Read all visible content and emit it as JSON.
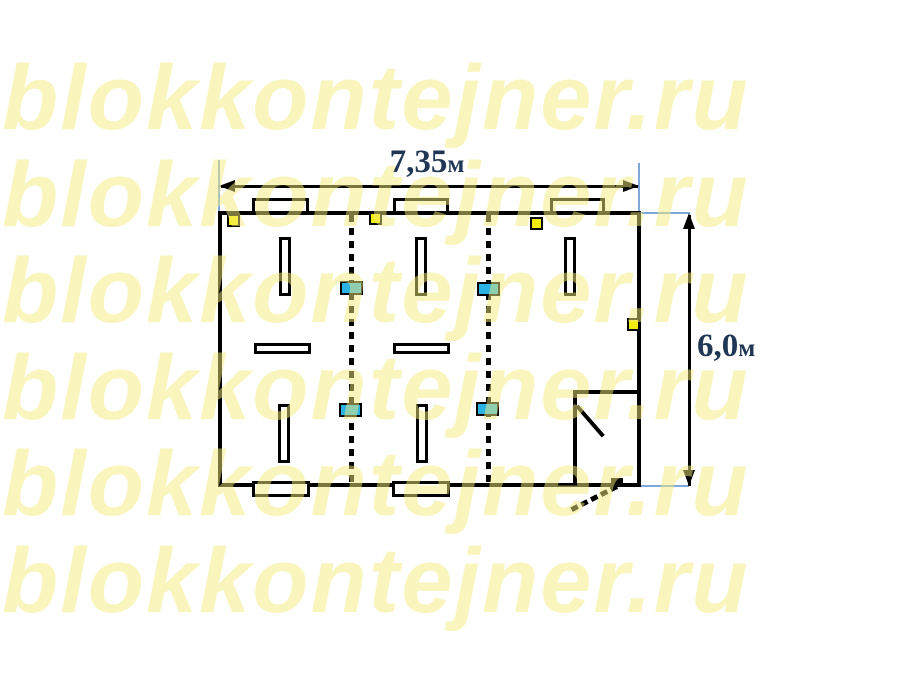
{
  "watermark": {
    "text": "blokkontejner.ru",
    "rows": 6,
    "color": "rgba(244,235,124,0.5)"
  },
  "dimensions": {
    "width": {
      "value": "7,35",
      "unit": "м"
    },
    "height": {
      "value": "6,0",
      "unit": "м"
    },
    "text_color": "#1F3655",
    "extension_line_color": "#7FA8DA"
  },
  "plan": {
    "colors": {
      "wall": "#000000",
      "fill": "#FFFFFF",
      "switch": "#F0EC0E",
      "socket": "#29B2E3"
    },
    "joints": [
      {
        "x": 349
      },
      {
        "x": 486
      }
    ],
    "windows_top": [
      {
        "x": 252,
        "w": 57
      },
      {
        "x": 393,
        "w": 56
      },
      {
        "x": 550,
        "w": 55
      }
    ],
    "windows_bottom": [
      {
        "x": 252,
        "w": 58
      },
      {
        "x": 392,
        "w": 58
      }
    ],
    "lights_vertical": [
      {
        "x": 279,
        "y": 237
      },
      {
        "x": 415,
        "y": 237
      },
      {
        "x": 564,
        "y": 237
      },
      {
        "x": 278,
        "y": 404
      },
      {
        "x": 416,
        "y": 404
      }
    ],
    "lights_horizontal": [
      {
        "x": 254,
        "y": 343
      },
      {
        "x": 393,
        "y": 343
      }
    ],
    "switches": [
      {
        "x": 227,
        "y": 214
      },
      {
        "x": 369,
        "y": 212
      },
      {
        "x": 530,
        "y": 217
      },
      {
        "x": 627,
        "y": 318
      }
    ],
    "sockets": [
      {
        "x": 340,
        "y": 281
      },
      {
        "x": 477,
        "y": 282
      },
      {
        "x": 339,
        "y": 403
      },
      {
        "x": 476,
        "y": 402
      }
    ]
  }
}
